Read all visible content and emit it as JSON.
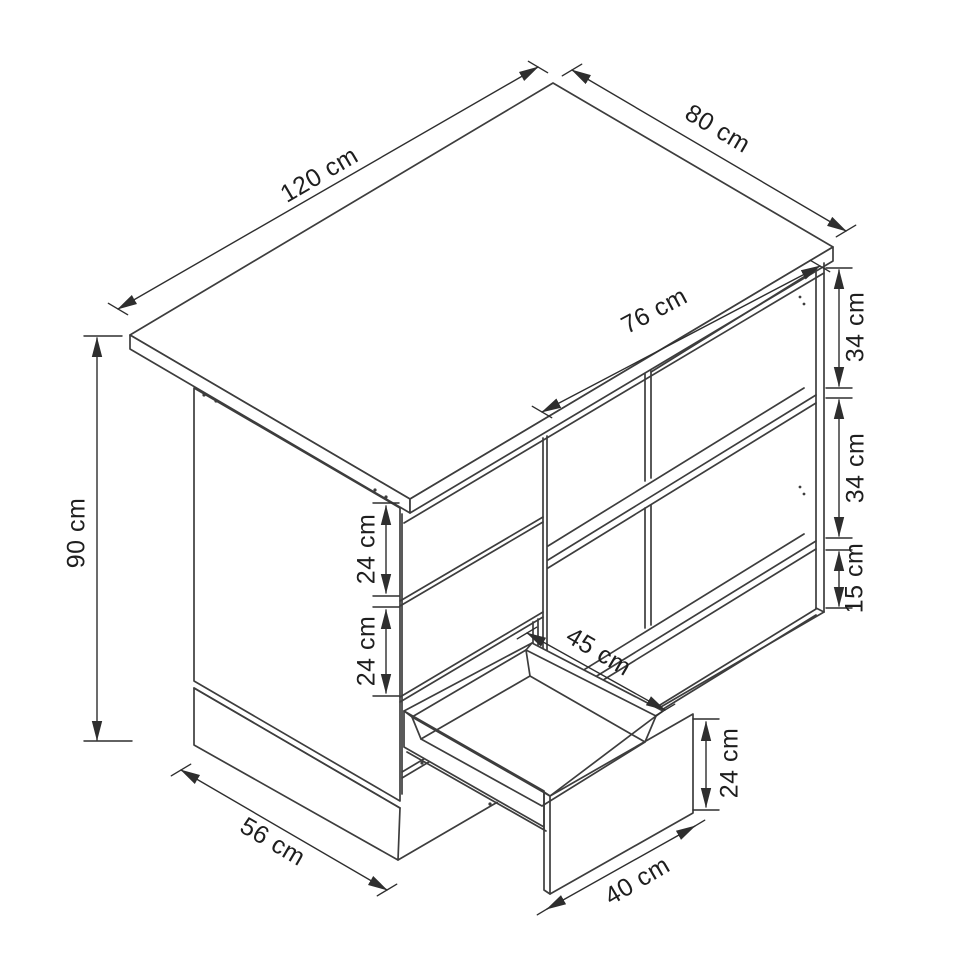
{
  "page": {
    "background": "#ffffff",
    "title": "Desk dimension drawing"
  },
  "diagram": {
    "type": "isometric-furniture-dimension-drawing",
    "object": "desk with side panel, two drawer fronts, open shelves and a pulled-out drawer",
    "unit": "cm",
    "line_color": "#3d3d3d",
    "dimension_color": "#2e2e2e",
    "text_color": "#1e1e1e",
    "dimensions": {
      "top_width": {
        "label": "120 cm",
        "value": 120
      },
      "top_depth": {
        "label": "80 cm",
        "value": 80
      },
      "opening_width": {
        "label": "76 cm",
        "value": 76
      },
      "height": {
        "label": "90 cm",
        "value": 90
      },
      "shelf_top_opening": {
        "label": "34 cm",
        "value": 34
      },
      "shelf_mid_opening": {
        "label": "34 cm",
        "value": 34
      },
      "bottom_opening": {
        "label": "15 cm",
        "value": 15
      },
      "drawer_front_upper": {
        "label": "24 cm",
        "value": 24
      },
      "drawer_front_lower": {
        "label": "24 cm",
        "value": 24
      },
      "drawer_depth": {
        "label": "45 cm",
        "value": 45
      },
      "drawer_height": {
        "label": "24 cm",
        "value": 24
      },
      "drawer_width": {
        "label": "40 cm",
        "value": 40
      },
      "base_depth": {
        "label": "56 cm",
        "value": 56
      }
    }
  }
}
